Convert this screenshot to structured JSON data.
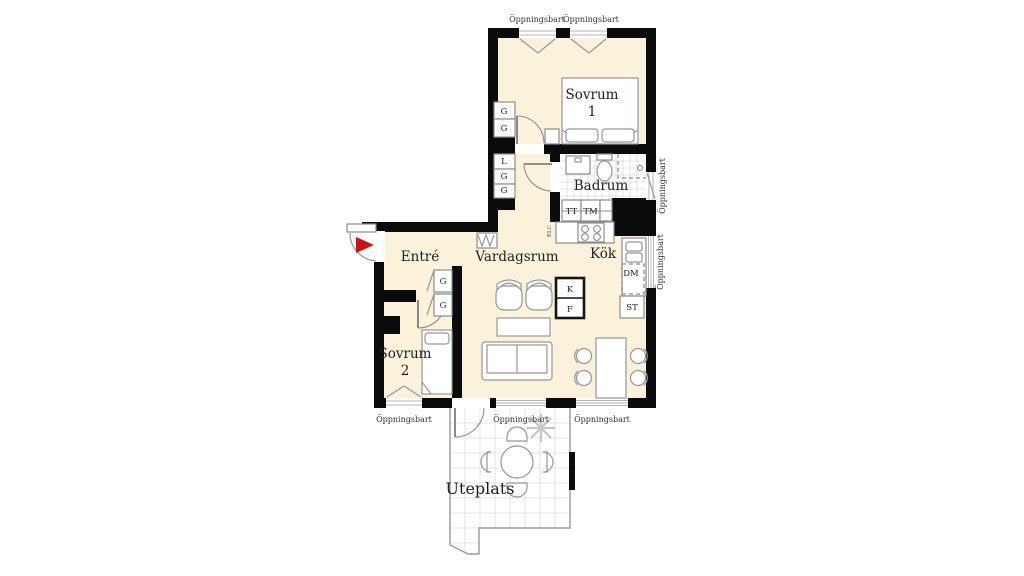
{
  "plan_title": "Apartment floor plan",
  "colors": {
    "floor": "#faf2da",
    "wall": "#0b0b0b",
    "tile_line": "#dcdcdc",
    "furniture_line": "#979797",
    "entrance_arrow": "#cc1212",
    "background": "#ffffff"
  },
  "rooms": {
    "sovrum1": {
      "name": "Sovrum",
      "number": "1"
    },
    "badrum": {
      "name": "Badrum"
    },
    "entre": {
      "name": "Entré"
    },
    "vardagsrum": {
      "name": "Vardagsrum"
    },
    "kok": {
      "name": "Kök"
    },
    "sovrum2": {
      "name": "Sovrum",
      "number": "2"
    },
    "uteplats": {
      "name": "Uteplats"
    }
  },
  "window_label": "Öppningsbart",
  "fixtures": {
    "wardrobe": "G",
    "linen_cabinet": "L",
    "dryer": "TT",
    "washer": "TM",
    "dishwasher": "DM",
    "tall_cabinet": "ST",
    "fridge": "K",
    "freezer": "F",
    "electrical": "ELC"
  }
}
